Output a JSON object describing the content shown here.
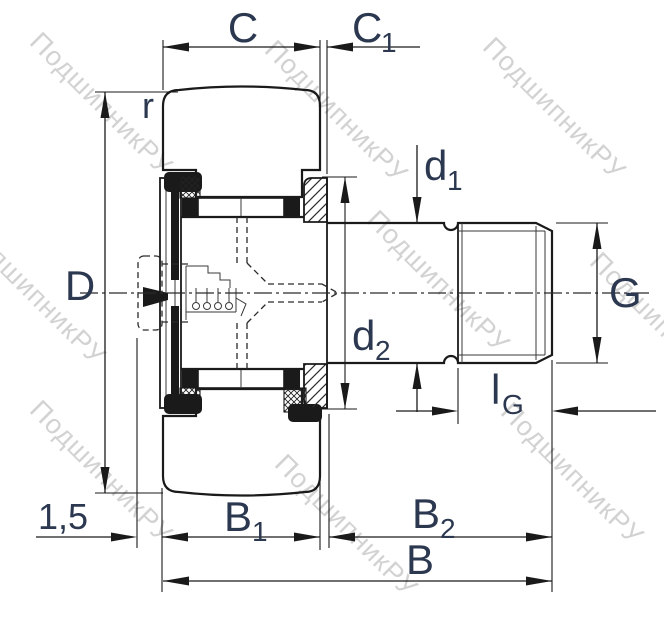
{
  "drawing": {
    "kind": "bearing-cross-section-technical-drawing",
    "watermark": {
      "text": "ПодшипникРУ",
      "color": "#cbcbcb"
    },
    "colors": {
      "line": "#1a1a1a",
      "label": "#2b3850",
      "background": "#ffffff"
    },
    "dimensions": {
      "C": {
        "text": "C"
      },
      "C1": {
        "text": "C",
        "sub": "1"
      },
      "r": {
        "text": "r"
      },
      "D": {
        "text": "D"
      },
      "d1": {
        "text": "d",
        "sub": "1"
      },
      "d2": {
        "text": "d",
        "sub": "2"
      },
      "G": {
        "text": "G"
      },
      "lG": {
        "text": "l",
        "sub": "G"
      },
      "B1": {
        "text": "B",
        "sub": "1"
      },
      "B2": {
        "text": "B",
        "sub": "2"
      },
      "B": {
        "text": "B"
      },
      "chamfer": {
        "text": "1,5"
      }
    }
  }
}
